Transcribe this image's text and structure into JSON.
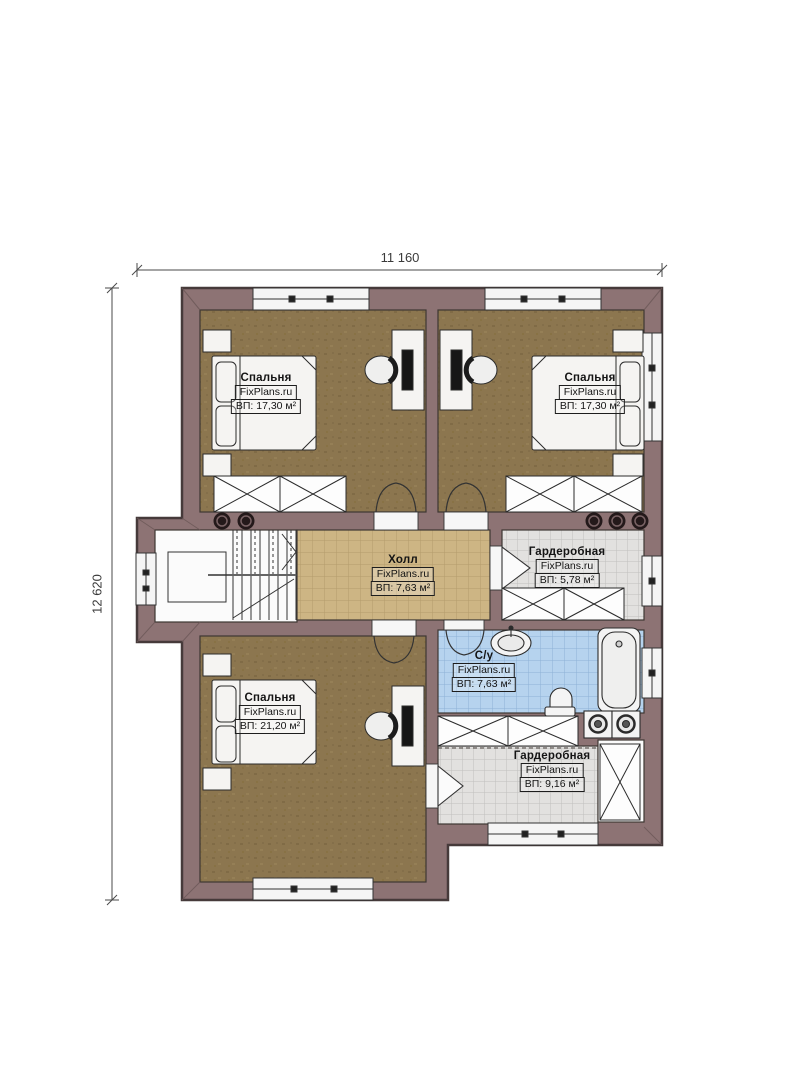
{
  "plan": {
    "dimension_width": "11 160",
    "dimension_height": "12 620",
    "rooms": [
      {
        "name": "Спальня",
        "brand": "FixPlans.ru",
        "area": "ВП: 17,30 м²"
      },
      {
        "name": "Спальня",
        "brand": "FixPlans.ru",
        "area": "ВП: 17,30 м²"
      },
      {
        "name": "Холл",
        "brand": "FixPlans.ru",
        "area": "ВП: 7,63 м²"
      },
      {
        "name": "Гардеробная",
        "brand": "FixPlans.ru",
        "area": "ВП: 5,78 м²"
      },
      {
        "name": "С/у",
        "brand": "FixPlans.ru",
        "area": "ВП: 7,63 м²"
      },
      {
        "name": "Спальня",
        "brand": "FixPlans.ru",
        "area": "ВП: 21,20 м²"
      },
      {
        "name": "Гардеробная",
        "brand": "FixPlans.ru",
        "area": "ВП: 9,16 м²"
      }
    ],
    "colors": {
      "wall": "#8d7374",
      "wall_outline": "#463a3a",
      "bedroom_floor": "#8c764f",
      "hall_floor": "#cdb584",
      "wardrobe_floor": "#e2e1df",
      "bathroom_floor": "#b6d3ee",
      "fixture_fill": "#f5f4f2"
    }
  }
}
